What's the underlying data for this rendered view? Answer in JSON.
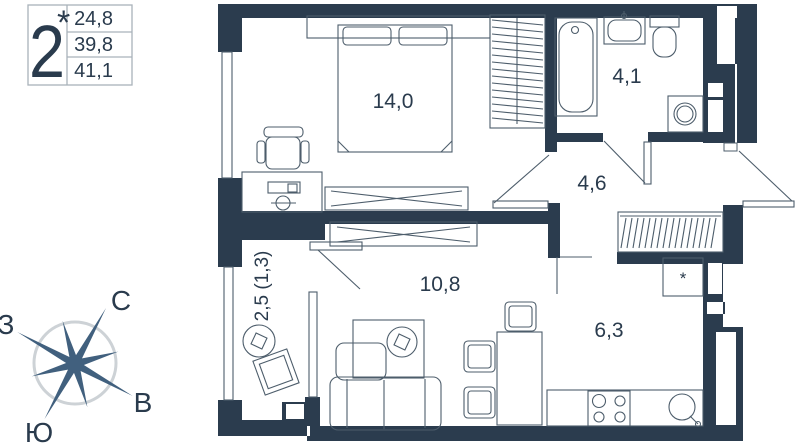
{
  "legend": {
    "rooms_count": "2",
    "asterisk": "*",
    "area_living": "24,8",
    "area_apartment": "39,8",
    "area_total": "41,1"
  },
  "rooms": {
    "bedroom": {
      "area": "14,0"
    },
    "bathroom": {
      "area": "4,1"
    },
    "hallway": {
      "area": "4,6"
    },
    "living": {
      "area": "10,8"
    },
    "kitchen": {
      "area": "6,3",
      "fridge_mark": "*"
    },
    "balcony": {
      "area": "2,5 (1,3)"
    }
  },
  "compass": {
    "north": "С",
    "west": "З",
    "east": "В",
    "south": "Ю"
  },
  "colors": {
    "wall": "#2b3c4e",
    "furniture_line": "#4d5d6b",
    "text": "#2a3b4d",
    "compass_star": "#41607e",
    "compass_ring": "#cdd2d6",
    "legend_border": "#a9b2ba"
  }
}
